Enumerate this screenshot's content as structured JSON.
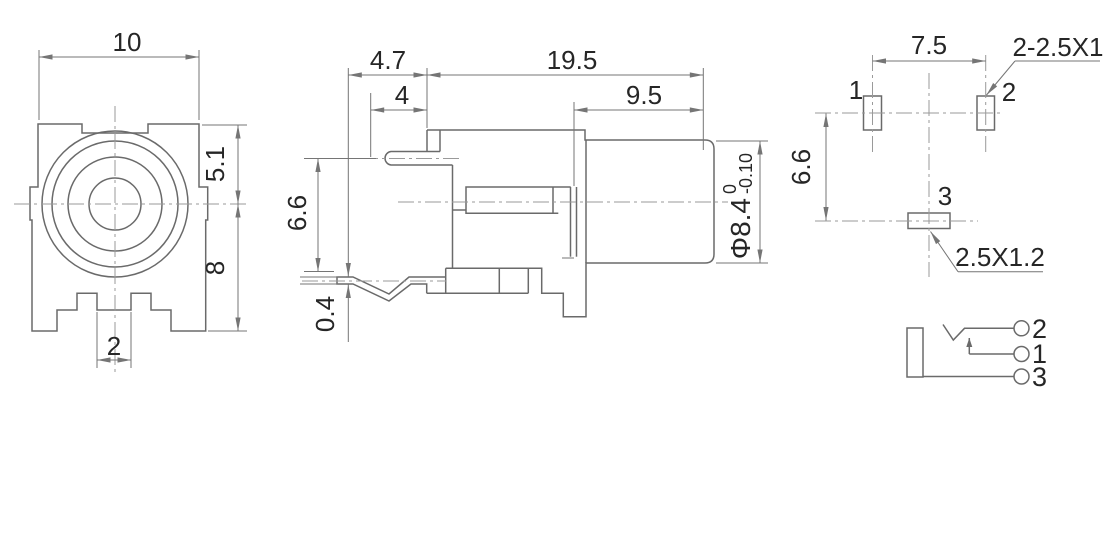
{
  "title": "phone jack connector engineering drawing",
  "colors": {
    "background": "#ffffff",
    "part_line": "#6a6a6a",
    "dim_line": "#757575",
    "center_line": "#9a9a9a",
    "text": "#262626"
  },
  "front": {
    "width": "10",
    "upper_height": "5.1",
    "lower_height": "8",
    "tab_width": "2"
  },
  "side": {
    "front_offset": "4.7",
    "pin_length": "4",
    "body_length": "19.5",
    "barrel_length": "9.5",
    "pin_height": "6.6",
    "leg_thickness": "0.4",
    "barrel_diameter": "Φ8.4",
    "tolerance_upper": "0",
    "tolerance_lower": "-0.10"
  },
  "footprint": {
    "pad_pitch": "7.5",
    "row_spacing": "6.6",
    "pad12_note": "2-2.5X1",
    "pad3_note": "2.5X1.2",
    "pin1": "1",
    "pin2": "2",
    "pin3": "3"
  },
  "schematic": {
    "pin_tip": "2",
    "pin_ring": "1",
    "pin_sleeve": "3"
  }
}
